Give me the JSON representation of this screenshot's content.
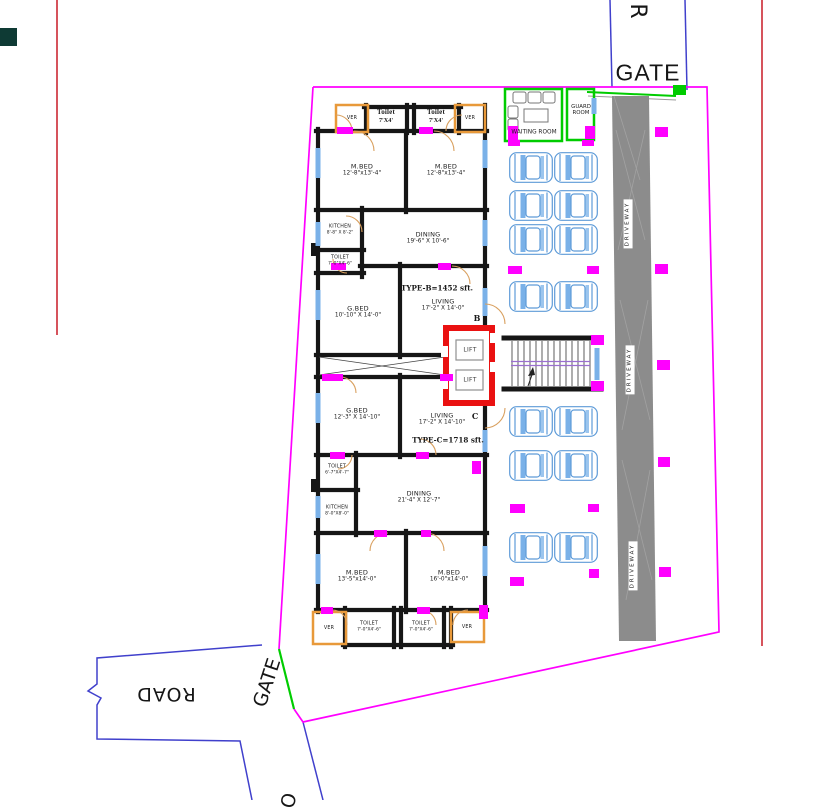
{
  "site": {
    "gate_top": "GATE",
    "gate_bottom": "GATE",
    "road_right": "R",
    "road_left": "ROAD",
    "road_bottom_partial": "O",
    "waiting_room": "WAITING ROOM",
    "guard_room_line1": "GUARD",
    "guard_room_line2": "ROOM",
    "driveway": "DRIVEWAY"
  },
  "units": {
    "type_b": "TYPE-B=1452 sft.",
    "type_c": "TYPE-C=1718 sft.",
    "tag_b": "B",
    "tag_c": "C"
  },
  "rooms": {
    "ver": "VER",
    "lift": "LIFT",
    "toilet_top": {
      "name": "Toilet",
      "dims": "7'X4'"
    },
    "mbed_b1": {
      "name": "M.BED",
      "dims": "12'-8\"x13'-4\""
    },
    "mbed_b2": {
      "name": "M.BED",
      "dims": "12'-8\"x13'-4\""
    },
    "kitchen_b": {
      "name": "KITCHEN",
      "dims": "8'-8\" X 8'-2\""
    },
    "dining_b": {
      "name": "DINING",
      "dims": "19'-6\" X 10'-6\""
    },
    "toilet_b": {
      "name": "TOILET",
      "dims": "7'-0\"X4'-6\""
    },
    "gbed_b": {
      "name": "G.BED",
      "dims": "10'-10\" X 14'-0\""
    },
    "living_b": {
      "name": "LIVING",
      "dims": "17'-2\" X 14'-0\""
    },
    "gbed_c": {
      "name": "G.BED",
      "dims": "12'-3\" X 14'-10\""
    },
    "living_c": {
      "name": "LIVING",
      "dims": "17'-2\" X 14'-10\""
    },
    "toilet_c": {
      "name": "TOILET",
      "dims": "6'-7\"X4'-7\""
    },
    "kitchen_c": {
      "name": "KITCHEN",
      "dims": "8'-0\"X8'-0\""
    },
    "dining_c": {
      "name": "DINING",
      "dims": "21'-4\" X 12'-7\""
    },
    "mbed_c1": {
      "name": "M.BED",
      "dims": "13'-5\"x14'-0\""
    },
    "mbed_c2": {
      "name": "M.BED",
      "dims": "16'-0\"x14'-0\""
    },
    "toilet_bottom1": {
      "name": "TOILET",
      "dims": "7'-0\"X4'-6\""
    },
    "toilet_bottom2": {
      "name": "TOILET",
      "dims": "7'-0\"X4'-6\""
    }
  },
  "colors": {
    "boundary": "#ff00ff",
    "road_line": "#4040cc",
    "red_line": "#cf3540",
    "gate_green": "#00cc00",
    "driveway_gray": "#8c8c8c",
    "wall_black": "#161616",
    "window_blue": "#7ab1e8",
    "veranda_orange": "#e8993a",
    "marker_magenta": "#ff00ff",
    "lift_red": "#ea1111",
    "car_blue": "#5e9bd8",
    "stair_rail_purple": "#9b6fd0"
  }
}
